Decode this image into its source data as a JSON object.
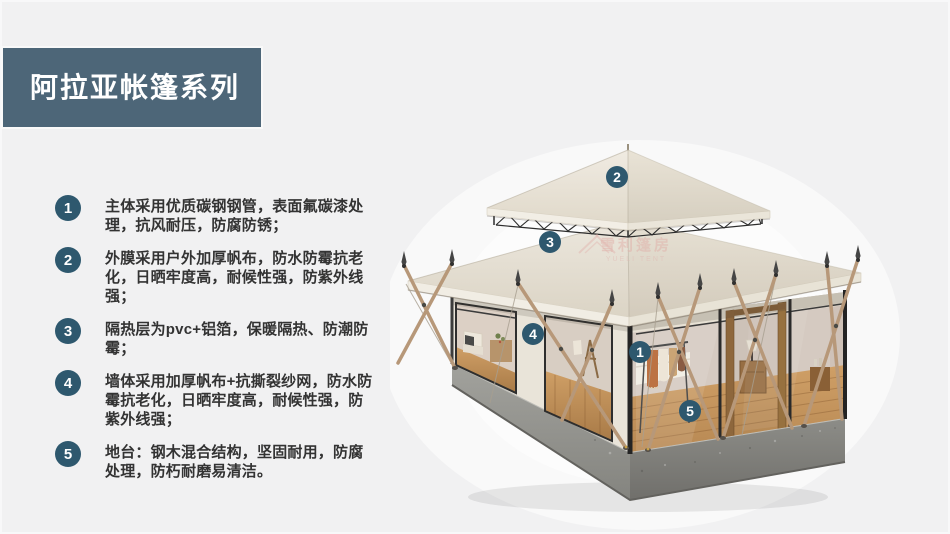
{
  "banner": {
    "title": "阿拉亚帐篷系列",
    "bg_color": "#4d6678",
    "text_color": "#ffffff"
  },
  "features": [
    {
      "num": "1",
      "text": "主体采用优质碳钢钢管，表面氟碳漆处理，抗风耐压，防腐防锈；"
    },
    {
      "num": "2",
      "text": "外膜采用户外加厚帆布，防水防霉抗老化，日晒牢度高，耐候性强，防紫外线强；"
    },
    {
      "num": "3",
      "text": "隔热层为pvc+铝箔，保暖隔热、防潮防霉；"
    },
    {
      "num": "4",
      "text": "墙体采用加厚帆布+抗撕裂纱网，防水防霉抗老化，日晒牢度高，耐候性强，防紫外线强；"
    },
    {
      "num": "5",
      "text": "地台：钢木混合结构，坚固耐用，防腐处理，防朽耐磨易清洁。"
    }
  ],
  "image": {
    "markers": [
      {
        "num": "1"
      },
      {
        "num": "2"
      },
      {
        "num": "3"
      },
      {
        "num": "4"
      },
      {
        "num": "5"
      }
    ],
    "watermark": {
      "cn": "雪利篷房",
      "en": "YUELI TENT"
    }
  },
  "colors": {
    "badge": "#2e586e",
    "banner": "#4d6678",
    "body_text": "#333333",
    "page_bg": "#f1f1f2"
  }
}
